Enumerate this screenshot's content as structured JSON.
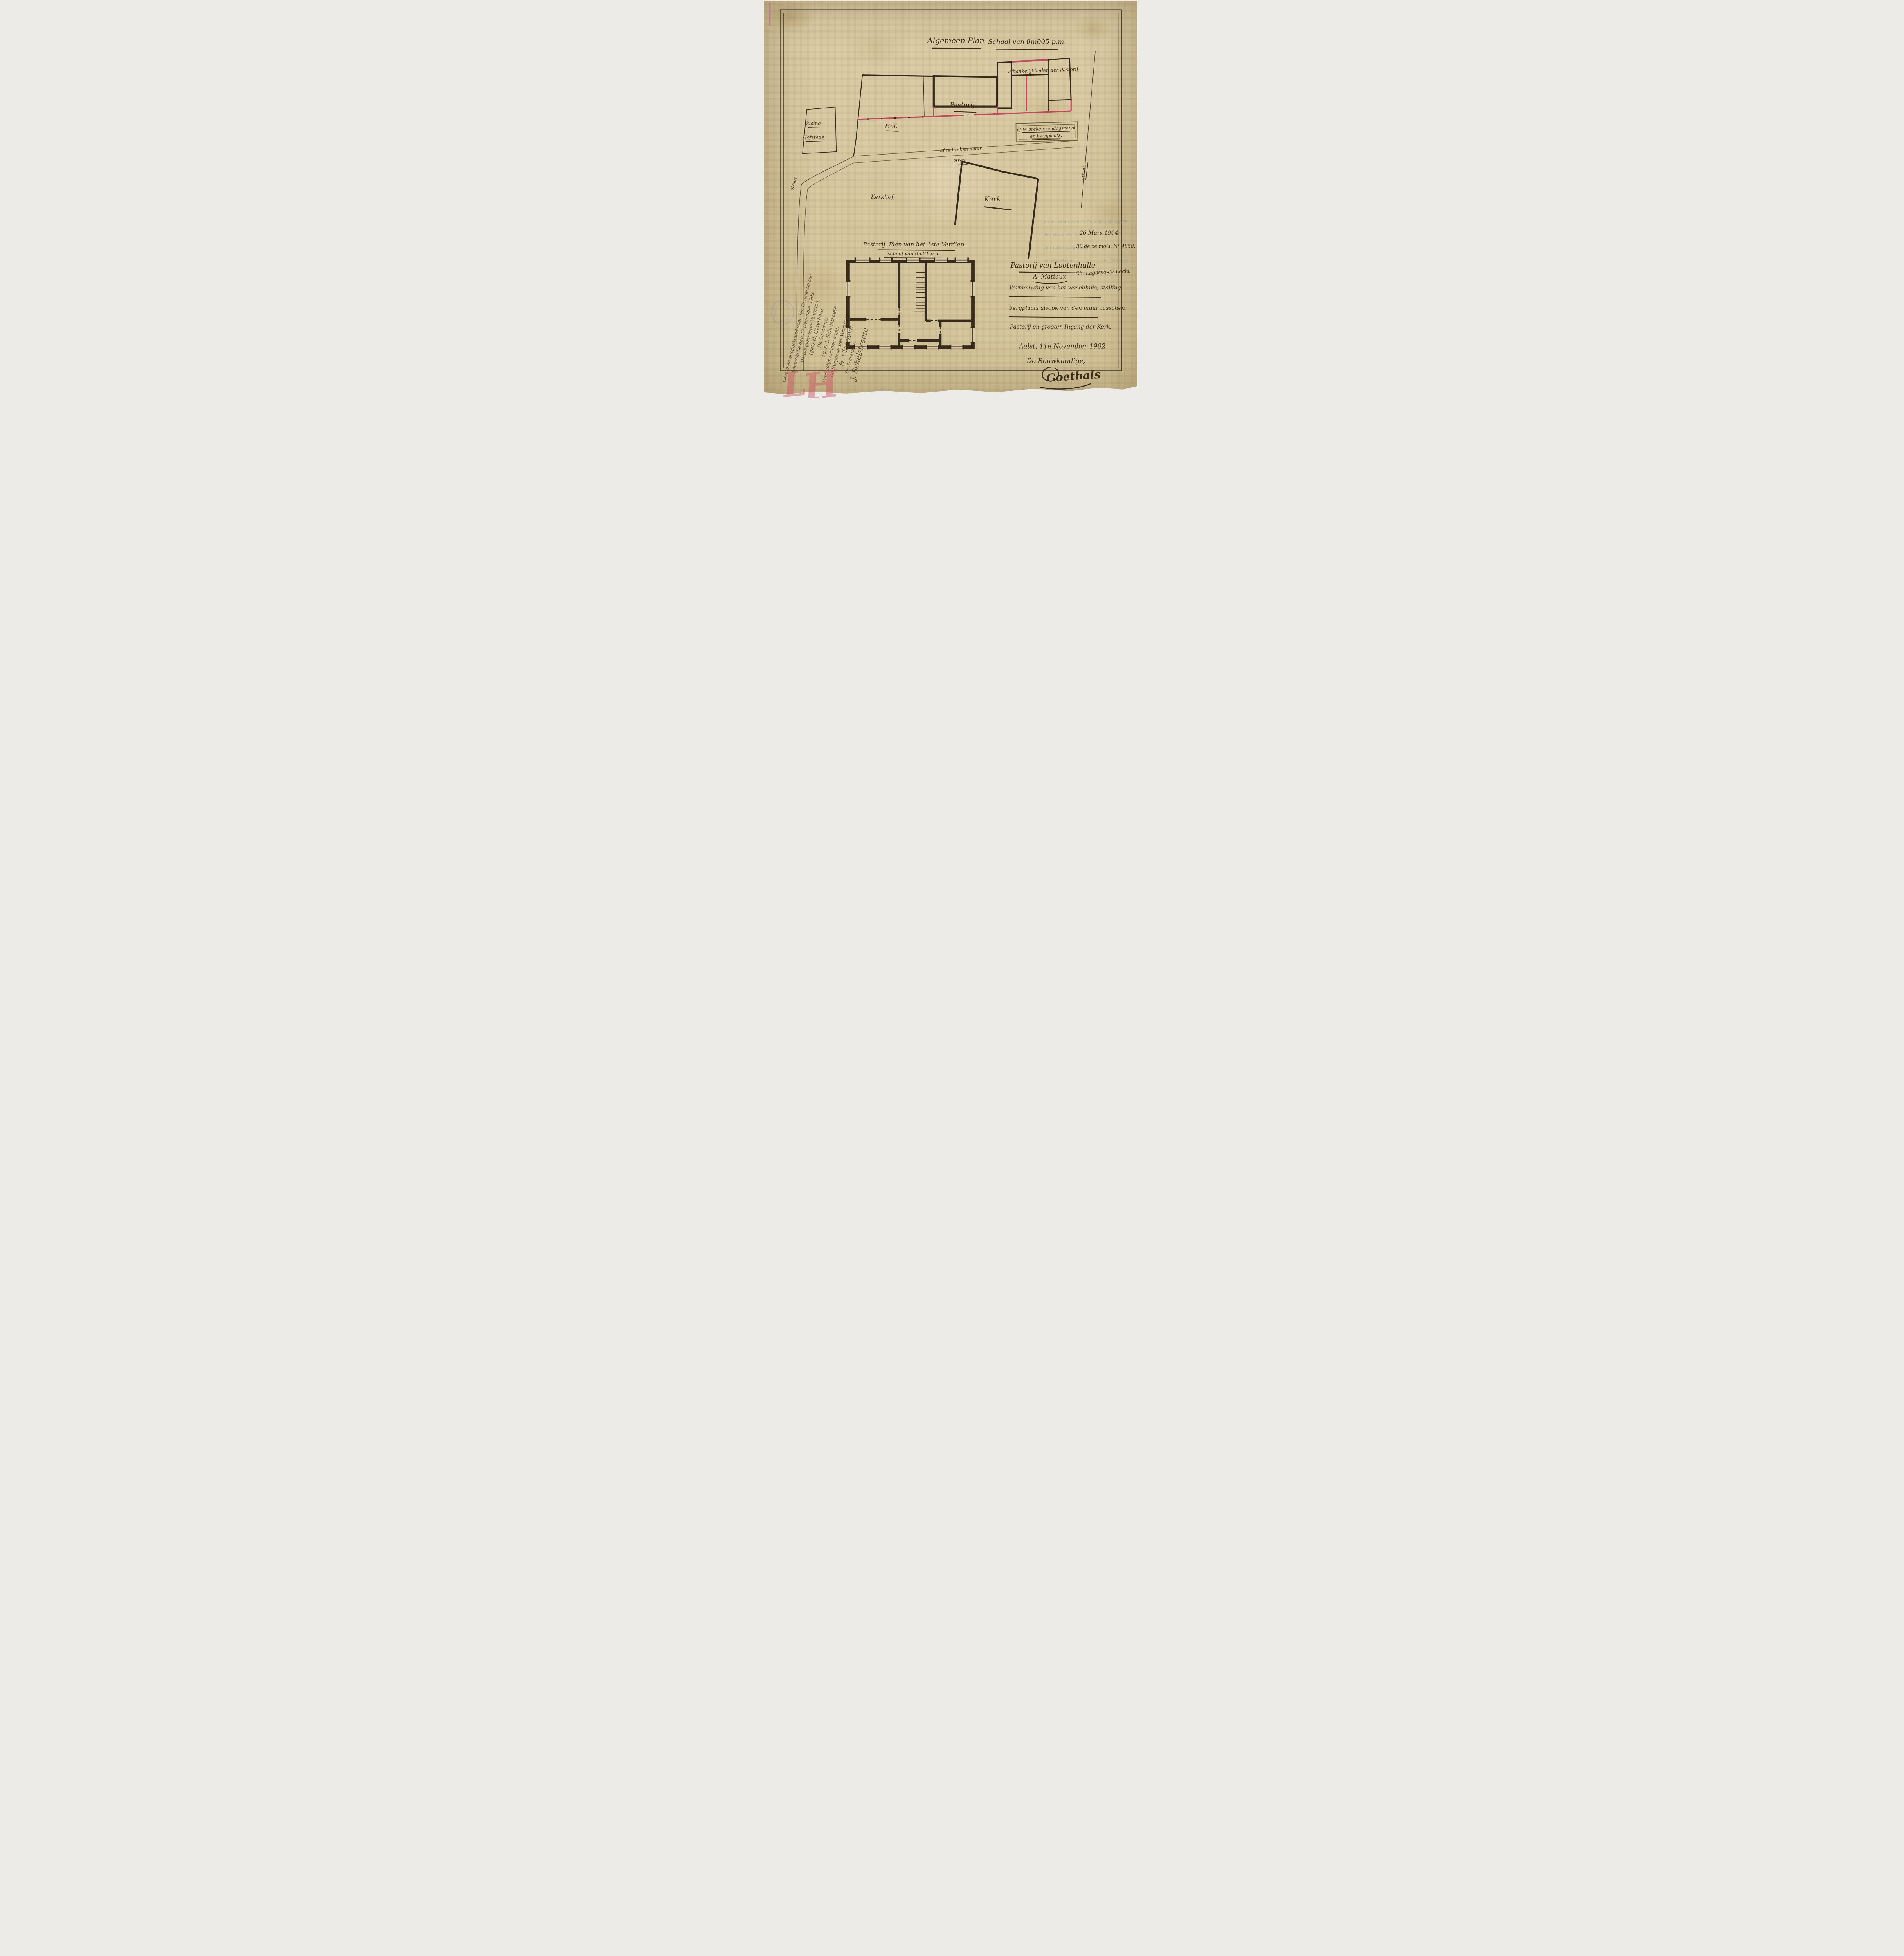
{
  "colors": {
    "paper": "#dbcda8",
    "ink": "#352a1b",
    "new_wall_red": "#c24a5f",
    "street_olive": "#6b5e39",
    "stamp_teal": "#7f9e99",
    "chalk_red": "#cc5260",
    "faint_stamp_blue": "#6b7fae"
  },
  "header": {
    "title": "Algemeen Plan",
    "scale": "Schaal van 0m005 p.m."
  },
  "site_plan": {
    "labels": {
      "hof": "Hof.",
      "pastorij": "Pastorij",
      "dependencies": "afhankelijkheden der Pastorij",
      "kleine": "kleine",
      "hofstede": "Hofstede",
      "school_line1": "af te breken zondagschool",
      "school_line2": "en bergplaats.",
      "demolish_wall": "af te breken muur",
      "street_bottom": "straat",
      "street_left": "straat",
      "street_right": "straat.",
      "kerkhof": "Kerkhof.",
      "kerk": "Kerk"
    }
  },
  "floor_plan": {
    "title": "Pastorij. Plan van het 1ste Verdiep.",
    "scale": "schaal van 0m01 p.m."
  },
  "project": {
    "line1": "Pastorij van Lootenhulle",
    "line2": "Vernieuwing van het waschhuis, stalling",
    "line3": "bergplaats alsook van den muur tusschen",
    "line4": "Pastorij en grooten Ingang der Kerk."
  },
  "signoff": {
    "place_date": "Aalst, 11e November 1902",
    "role": "De Bouwkundige,",
    "signature": "Goethals"
  },
  "stamp": {
    "line1": "Vu en séance de la Commission royale",
    "line2": "des Monuments",
    "line3": "voir notre rapport du",
    "secretary": "Le Secrétaire",
    "president": "Le Président",
    "date": "26 Mars 1904.",
    "report": "30 de ce mois, N° 4868.",
    "secretary_sig": "A. Mattaux",
    "president_sig": "Ch. Lagasse-de Locht"
  },
  "council": {
    "lines": [
      "Gezien en goedgekeurd door den Gemeenteraad",
      "Lootenhulle den 27 December 1902",
      "De Burgemeester Voorzitter,",
      "(get) H. Claerhout",
      "De Secretaris,",
      "(get) J. Schelstraete",
      "Voor gelijkvormige kopij:",
      "De Burgemeester Voorzitter,",
      "H. Claerhout",
      "De Secretaris,",
      "J. Schelstraete"
    ]
  },
  "marks": {
    "initial_l": "L",
    "initial_h": "H"
  }
}
